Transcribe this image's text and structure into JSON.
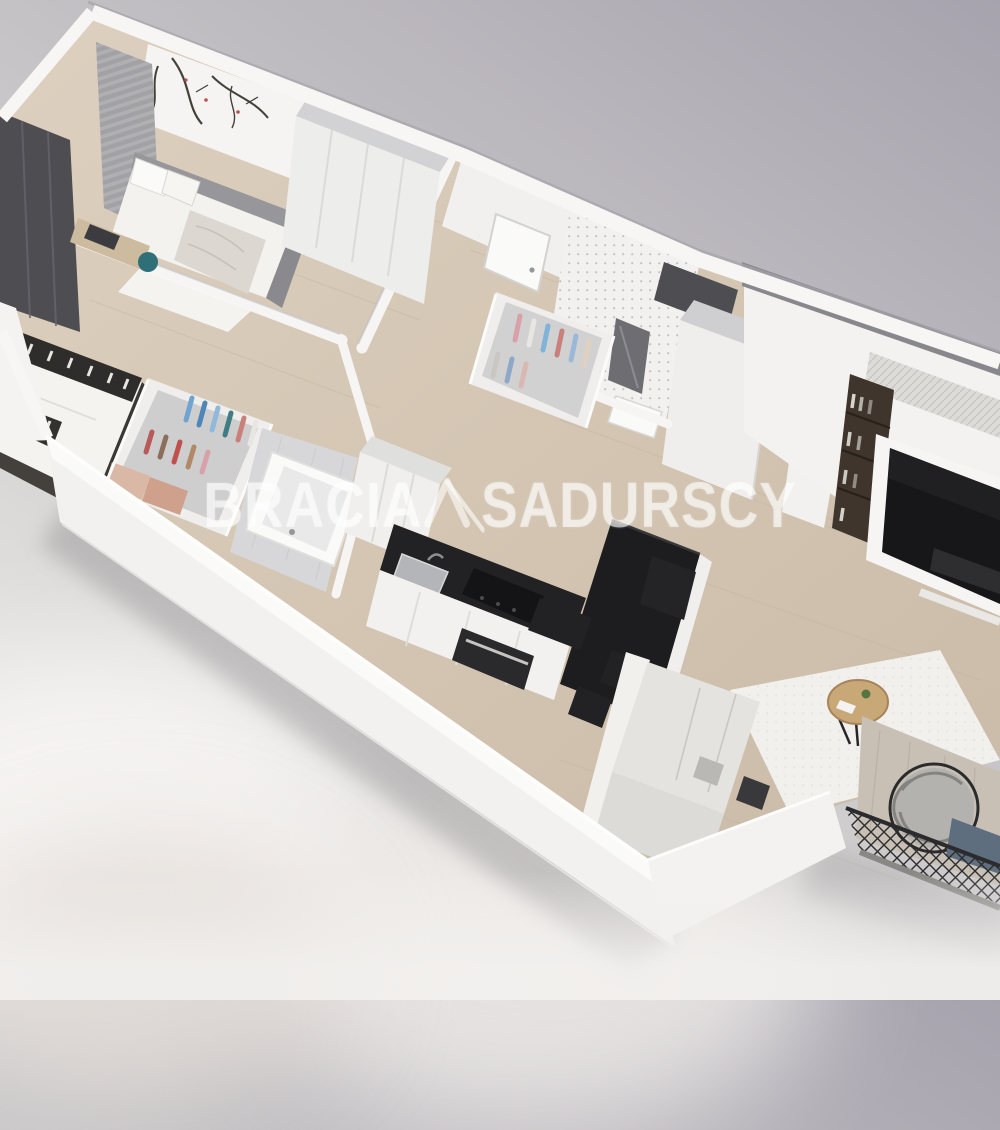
{
  "watermark": {
    "brand_first": "BRACIA",
    "brand_second": "SADURSCY",
    "logo": "roof-slash-monogram",
    "color": "#ffffff",
    "opacity": 0.58
  },
  "scene": {
    "type": "3d-apartment-floorplan-render",
    "view": "axonometric-cutaway",
    "rooms": [
      {
        "name": "bedroom-small",
        "items": [
          "floral-branch-wallpaper",
          "gray-curtains",
          "dark-curtain-panel",
          "daybed-with-pillows",
          "textured-blanket",
          "desk",
          "teal-chair",
          "white-wardrobe",
          "white-rug"
        ]
      },
      {
        "name": "bedroom-master",
        "items": [
          "double-bed",
          "patterned-black-white-runner",
          "dark-bed-frame",
          "open-wardrobe-with-clothes"
        ]
      },
      {
        "name": "bathroom-main",
        "items": [
          "bathtub",
          "gray-tile-floor"
        ]
      },
      {
        "name": "hallway",
        "items": [
          "entrance-door",
          "open-closet-with-clothes"
        ]
      },
      {
        "name": "bathroom-small",
        "items": [
          "mosaic-dot-wall",
          "mirror",
          "washbasin",
          "dark-niche"
        ]
      },
      {
        "name": "kitchen",
        "items": [
          "tall-white-cabinets",
          "black-countertop",
          "steel-sink",
          "black-cooktop",
          "oven",
          "white-island"
        ]
      },
      {
        "name": "dining-area",
        "items": [
          "black-dining-table",
          "black-stools"
        ]
      },
      {
        "name": "living-room",
        "items": [
          "tv-feature-wall",
          "tv-screen",
          "wood-bookshelf",
          "textured-panel",
          "light-sofa",
          "dark-armchair",
          "white-rug",
          "round-wood-coffee-table",
          "plant"
        ]
      },
      {
        "name": "balcony",
        "items": [
          "lattice-railing",
          "round-wicker-chair",
          "blue-cushion",
          "glass-door"
        ]
      }
    ],
    "palette": {
      "background_top": "#a6a3ae",
      "background_bottom": "#f1efed",
      "wall_white": "#f6f5f3",
      "wall_top_gray": "#87878c",
      "wood_floor": "#d5c7b4",
      "tile_gray": "#d7d7d9",
      "black_furniture": "#202022",
      "sofa_gray": "#e4e3e0",
      "steel": "#b4b5b8",
      "teal_chair": "#2e6f78",
      "table_wood": "#c9a877",
      "bookshelf_wood": "#40352d",
      "cushion_blue": "#5e6e7e",
      "clothes_accents": [
        "#6fa3d0",
        "#3f7d85",
        "#b85a5a",
        "#b08968",
        "#d8a0a8"
      ]
    }
  }
}
